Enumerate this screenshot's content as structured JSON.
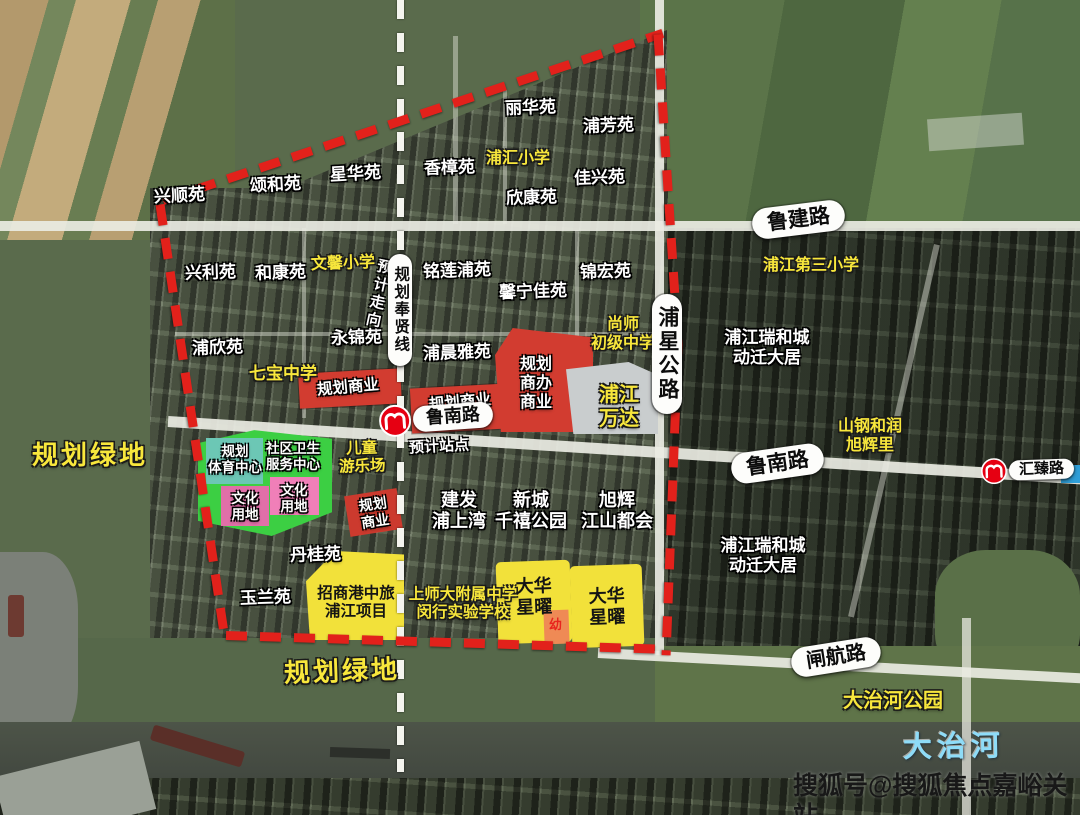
{
  "roads": {
    "lujian": "鲁建路",
    "lunan": "鲁南路",
    "zhahang": "闸航路",
    "puxing": "浦星公路"
  },
  "metro": {
    "lunan_station": "鲁南路",
    "huizhen_station": "汇臻路",
    "expected_station": "预计站点",
    "planned_line": "规划奉贤线",
    "expected_direction": "预计走向"
  },
  "zones": {
    "commercial_a": "规划商业",
    "commercial_b": "规划商业",
    "commercial_small": "规划\n商业",
    "commercial_office": "规划\n商办\n商业",
    "sports_center": "规划\n体育中心",
    "health_center": "社区卫生\n服务中心",
    "culture_a": "文化\n用地",
    "culture_b": "文化\n用地",
    "children_playground": "儿童\n游乐场",
    "kindergarten": "幼",
    "green_left": "规划绿地",
    "green_bottom": "规划绿地"
  },
  "projects": {
    "wanda": "浦江\n万达",
    "zhaoshang": "招商港中旅\n浦江项目",
    "dahua_a": "大华\n星曜",
    "dahua_b": "大华\n星曜",
    "jianfa": "建发\n浦上湾",
    "xincheng": "新城\n千禧公园",
    "xuhui": "旭辉\n江山都会",
    "shangang": "山钢和润\n旭辉里"
  },
  "estates": {
    "xingshun": "兴顺苑",
    "songhe": "颂和苑",
    "xinghua": "星华苑",
    "xiangzhang": "香樟苑",
    "lihua": "丽华苑",
    "pufang": "浦芳苑",
    "jiaxing": "佳兴苑",
    "xinkang": "欣康苑",
    "xingli": "兴利苑",
    "hekang": "和康苑",
    "minglianpu": "铭莲浦苑",
    "xinningjia": "馨宁佳苑",
    "jinhong": "锦宏苑",
    "puxin": "浦欣苑",
    "yongjin": "永锦苑",
    "puchenya": "浦晨雅苑",
    "dangui": "丹桂苑",
    "yulan": "玉兰苑"
  },
  "schools": {
    "puhui": "浦汇小学",
    "wenxin": "文馨小学",
    "qibao": "七宝中学",
    "pujiang_third": "浦江第三小学",
    "shangshi": "尚师\n初级中学",
    "shangshida": "上师大附属中学\n闵行实验学校"
  },
  "places": {
    "ruihecheng_north": "浦江瑞和城\n动迁大居",
    "ruihecheng_south": "浦江瑞和城\n动迁大居",
    "dazhihe_park": "大治河公园",
    "dazhihe_river": "大治河"
  },
  "watermark": "搜狐号@搜狐焦点嘉峪关站",
  "colors": {
    "boundary_red": "#e2211b",
    "commercial_red": "#d23c30",
    "planning_yellow": "#f2e13a",
    "green_zone": "#3ccf43",
    "teal_zone": "#6cc7b5",
    "pink_zone": "#e87fb0",
    "kindergarten_orange": "#ef8a55",
    "label_yellow": "#f8e73c",
    "river_blue": "#8edcf8",
    "metro_red": "#e60012"
  }
}
